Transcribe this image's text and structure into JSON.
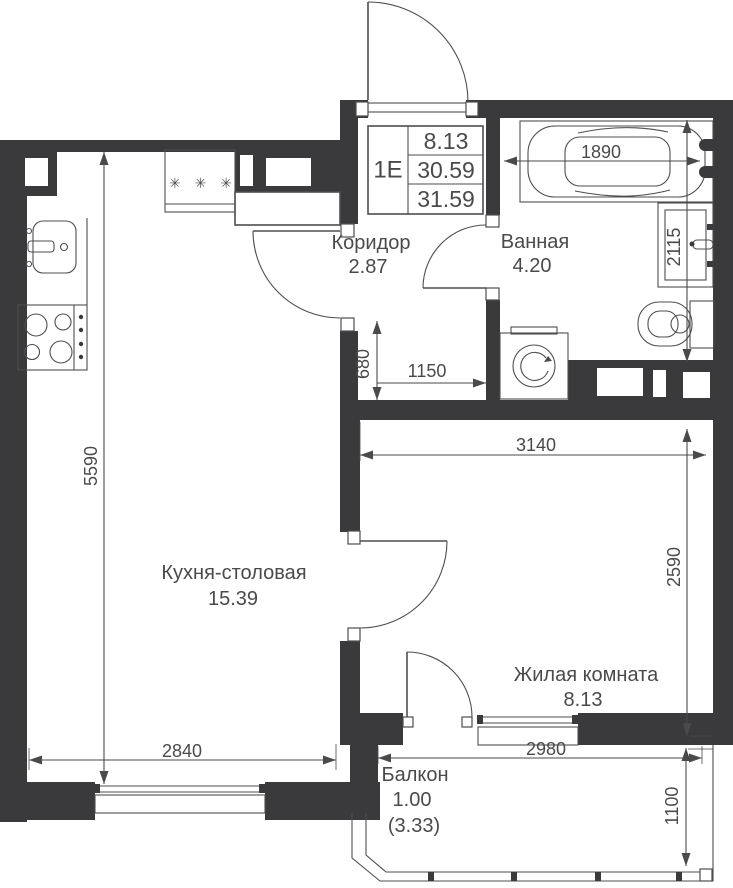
{
  "plan": {
    "title_block": {
      "flat_type": "1Е",
      "living_area": "8.13",
      "area": "30.59",
      "total_area": "31.59"
    },
    "rooms": {
      "corridor": {
        "name": "Коридор",
        "area": "2.87"
      },
      "bathroom": {
        "name": "Ванная",
        "area": "4.20"
      },
      "kitchen": {
        "name": "Кухня-столовая",
        "area": "15.39"
      },
      "living": {
        "name": "Жилая комната",
        "area": "8.13"
      },
      "balcony": {
        "name": "Балкон",
        "area": "1.00",
        "area_with_coeff": "(3.33)"
      }
    },
    "dims": {
      "bathtub_length": "1890",
      "bathroom_depth": "2115",
      "kitchen_depth": "5590",
      "hall_niche_depth": "680",
      "hall_niche_width": "1150",
      "living_width": "3140",
      "living_depth": "2590",
      "kitchen_width": "2840",
      "balcony_width": "2980",
      "balcony_depth": "1100"
    },
    "symbols": {
      "fridge": "✳ ✳ ✳"
    },
    "colors": {
      "wall": "#3A3A3C",
      "line": "#4E4E50",
      "text": "#4A4A4C",
      "background": "#FFFFFF"
    }
  }
}
